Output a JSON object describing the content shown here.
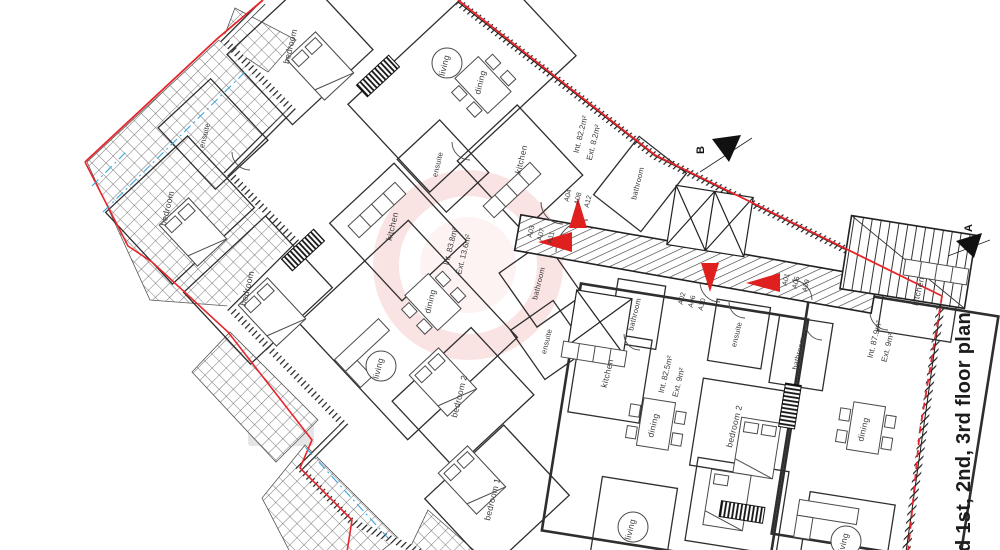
{
  "drawing": {
    "title": "d 1st, 2nd, 3rd floor plan",
    "section_markers": {
      "a": "A",
      "b": "B"
    },
    "rooms": {
      "ensuite_tl": "ensuite",
      "bedroom_tl1": "bedroom",
      "bedroom_tl2": "bedroom",
      "bedroom_tl3": "bedroom",
      "living_top": "living",
      "dining_top": "dining",
      "kitchen_top": "kitchen",
      "ensuite_top": "ensuite",
      "bathroom_top": "bathroom",
      "kitchen_left": "kitchen",
      "dining_left": "dining",
      "living_left": "living",
      "bathroom_left": "bathroom",
      "ensuite_left": "ensuite",
      "bedroom2_left": "bedroom 2",
      "bedroom1_left": "bedroom 1",
      "bathroom_mid": "bathroom",
      "kitchen_mid": "kitchen",
      "dining_mid": "dining",
      "bedroom2_mid": "bedroom 2",
      "living_mid": "living",
      "ensuite_right": "ensuite",
      "bathroom_right": "bathroom",
      "kitchen_right": "kitchen",
      "dining_right": "dining",
      "living_right": "living"
    },
    "areas": {
      "top_int": "Int. 82.2m²",
      "top_ext": "Ext. 8.2m²",
      "left_int": "Int. 83.8m²",
      "left_ext": "Ext. 13.6m²",
      "mid_int": "Int. 82.5m²",
      "mid_ext": "Ext. 9m²",
      "right_int": "Int. 87.9m²",
      "right_ext": "Ext. 9m²"
    },
    "units": {
      "stack1": {
        "l1": "A04",
        "l2": "A08",
        "l3": "A12"
      },
      "stack2": {
        "l1": "A03",
        "l2": "A07",
        "l3": "A11"
      },
      "stack3": {
        "l1": "A02",
        "l2": "A06",
        "l3": "A10"
      },
      "stack4": {
        "l1": "A01",
        "l2": "A05",
        "l3": "A09"
      }
    },
    "colors": {
      "boundary_red": "#e8252a",
      "arrow_red": "#e0201f",
      "guide_blue": "#35a8e0",
      "wall": "#1a1a1a",
      "text": "#3a3a3a"
    }
  }
}
